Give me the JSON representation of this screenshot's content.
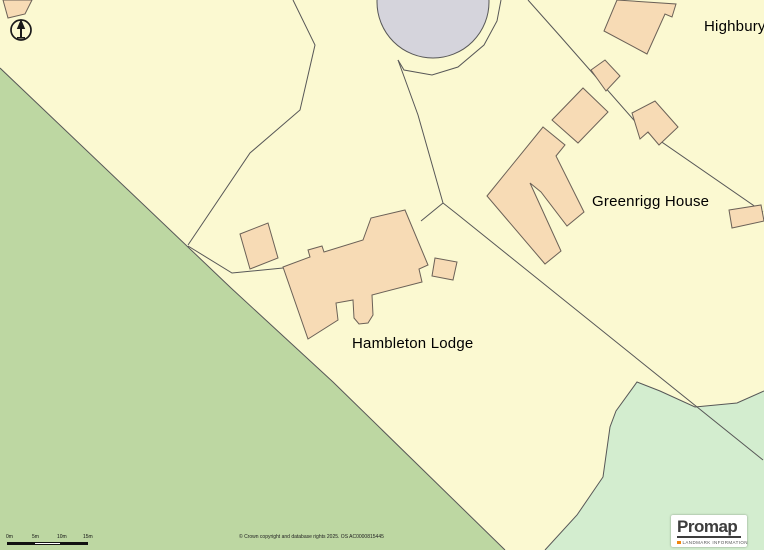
{
  "window": {
    "width": 764,
    "height": 550
  },
  "map": {
    "background": "#fbf9d1",
    "colors": {
      "boundary": "#575757",
      "building_fill": "#f7dbb5",
      "building_stroke": "#6b6157",
      "water_fill": "#d5d4dc",
      "woodland_fill": "#bdd7a2",
      "meadow_fill": "#d3edcf"
    },
    "regions": [
      {
        "name": "woodland-band",
        "fill": "#bdd7a2",
        "points": [
          [
            0,
            68
          ],
          [
            231,
            288
          ],
          [
            333,
            382
          ],
          [
            505,
            550
          ],
          [
            0,
            550
          ]
        ]
      },
      {
        "name": "meadow-bottom-right",
        "fill": "#d3edcf",
        "points": [
          [
            764,
            391
          ],
          [
            737,
            403
          ],
          [
            695,
            407
          ],
          [
            660,
            391
          ],
          [
            637,
            382
          ],
          [
            616,
            411
          ],
          [
            610,
            427
          ],
          [
            603,
            477
          ],
          [
            577,
            515
          ],
          [
            545,
            550
          ],
          [
            764,
            550
          ]
        ]
      }
    ],
    "pond": {
      "name": "pond",
      "cx": 433,
      "cy": 2,
      "rx": 56,
      "ry": 56,
      "fill": "#d5d4dc"
    },
    "boundaries": [
      {
        "name": "woodland-edge",
        "points": [
          [
            0,
            68
          ],
          [
            231,
            288
          ],
          [
            333,
            382
          ],
          [
            505,
            550
          ]
        ]
      },
      {
        "name": "meadow-edge",
        "points": [
          [
            764,
            391
          ],
          [
            737,
            403
          ],
          [
            695,
            407
          ],
          [
            660,
            391
          ],
          [
            637,
            382
          ],
          [
            616,
            411
          ],
          [
            610,
            427
          ],
          [
            603,
            477
          ],
          [
            577,
            515
          ],
          [
            545,
            550
          ]
        ]
      },
      {
        "name": "track-west",
        "points": [
          [
            293,
            0
          ],
          [
            315,
            45
          ],
          [
            300,
            110
          ],
          [
            250,
            153
          ],
          [
            188,
            245
          ]
        ]
      },
      {
        "name": "fence-west",
        "points": [
          [
            188,
            246
          ],
          [
            232,
            273
          ],
          [
            283,
            268
          ]
        ]
      },
      {
        "name": "pond-enclosure",
        "points": [
          [
            398,
            60
          ],
          [
            404,
            70
          ],
          [
            432,
            75
          ],
          [
            458,
            67
          ],
          [
            484,
            45
          ],
          [
            497,
            21
          ],
          [
            501,
            0
          ]
        ]
      },
      {
        "name": "boundary-central",
        "points": [
          [
            398,
            60
          ],
          [
            418,
            115
          ],
          [
            443,
            203
          ],
          [
            457,
            214
          ],
          [
            763,
            460
          ]
        ]
      },
      {
        "name": "fence-east",
        "points": [
          [
            443,
            203
          ],
          [
            421,
            221
          ]
        ]
      },
      {
        "name": "boundary-east",
        "points": [
          [
            528,
            0
          ],
          [
            560,
            36
          ],
          [
            640,
            127
          ],
          [
            763,
            212
          ]
        ]
      }
    ],
    "buildings": [
      {
        "name": "corner-building-nw",
        "points": [
          [
            3,
            0
          ],
          [
            32,
            0
          ],
          [
            25,
            14
          ],
          [
            8,
            18
          ]
        ]
      },
      {
        "name": "hambleton-lodge-house",
        "points": [
          [
            283,
            267
          ],
          [
            310,
            257
          ],
          [
            308,
            250
          ],
          [
            322,
            246
          ],
          [
            324,
            252
          ],
          [
            363,
            240
          ],
          [
            371,
            218
          ],
          [
            405,
            210
          ],
          [
            428,
            265
          ],
          [
            419,
            269
          ],
          [
            422,
            282
          ],
          [
            372,
            295
          ],
          [
            373,
            315
          ],
          [
            368,
            323
          ],
          [
            359,
            324
          ],
          [
            354,
            318
          ],
          [
            353,
            300
          ],
          [
            336,
            303
          ],
          [
            338,
            320
          ],
          [
            308,
            339
          ]
        ]
      },
      {
        "name": "hambleton-outbuilding-west",
        "points": [
          [
            240,
            234
          ],
          [
            268,
            223
          ],
          [
            278,
            258
          ],
          [
            250,
            269
          ]
        ]
      },
      {
        "name": "hambleton-outbuilding-east",
        "points": [
          [
            435,
            258
          ],
          [
            457,
            262
          ],
          [
            453,
            280
          ],
          [
            432,
            276
          ]
        ]
      },
      {
        "name": "greenrigg-house-building",
        "points": [
          [
            487,
            196
          ],
          [
            543,
            127
          ],
          [
            565,
            145
          ],
          [
            556,
            156
          ],
          [
            584,
            212
          ],
          [
            567,
            226
          ],
          [
            541,
            192
          ],
          [
            530,
            183
          ],
          [
            561,
            251
          ],
          [
            545,
            264
          ]
        ]
      },
      {
        "name": "greenrigg-outbuilding-nw",
        "points": [
          [
            552,
            120
          ],
          [
            583,
            88
          ],
          [
            608,
            112
          ],
          [
            578,
            143
          ]
        ]
      },
      {
        "name": "greenrigg-outbuilding-n",
        "points": [
          [
            591,
            70
          ],
          [
            605,
            60
          ],
          [
            620,
            76
          ],
          [
            606,
            91
          ]
        ]
      },
      {
        "name": "greenrigg-outbuilding-ne",
        "points": [
          [
            632,
            113
          ],
          [
            655,
            101
          ],
          [
            678,
            127
          ],
          [
            659,
            145
          ],
          [
            648,
            132
          ],
          [
            640,
            139
          ]
        ]
      },
      {
        "name": "outbuilding-se",
        "points": [
          [
            729,
            210
          ],
          [
            761,
            205
          ],
          [
            764,
            221
          ],
          [
            732,
            228
          ]
        ]
      },
      {
        "name": "highbury-house",
        "points": [
          [
            617,
            0
          ],
          [
            676,
            4
          ],
          [
            672,
            17
          ],
          [
            665,
            14
          ],
          [
            647,
            54
          ],
          [
            604,
            31
          ]
        ]
      }
    ],
    "labels": [
      {
        "name": "highbury-label",
        "text": "Highbury",
        "x": 704,
        "y": 18
      },
      {
        "name": "greenrigg-house-label",
        "text": "Greenrigg House",
        "x": 592,
        "y": 193
      },
      {
        "name": "hambleton-lodge-label",
        "text": "Hambleton Lodge",
        "x": 352,
        "y": 335
      }
    ]
  },
  "scale_bar": {
    "ticks": [
      "0m",
      "5m",
      "10m",
      "15m"
    ]
  },
  "attribution": "© Crown copyright and database rights 2025. OS AC0000815445",
  "logo": {
    "brand": "Promap",
    "tagline": "LANDMARK INFORMATION",
    "accent_color": "#f0860f"
  }
}
